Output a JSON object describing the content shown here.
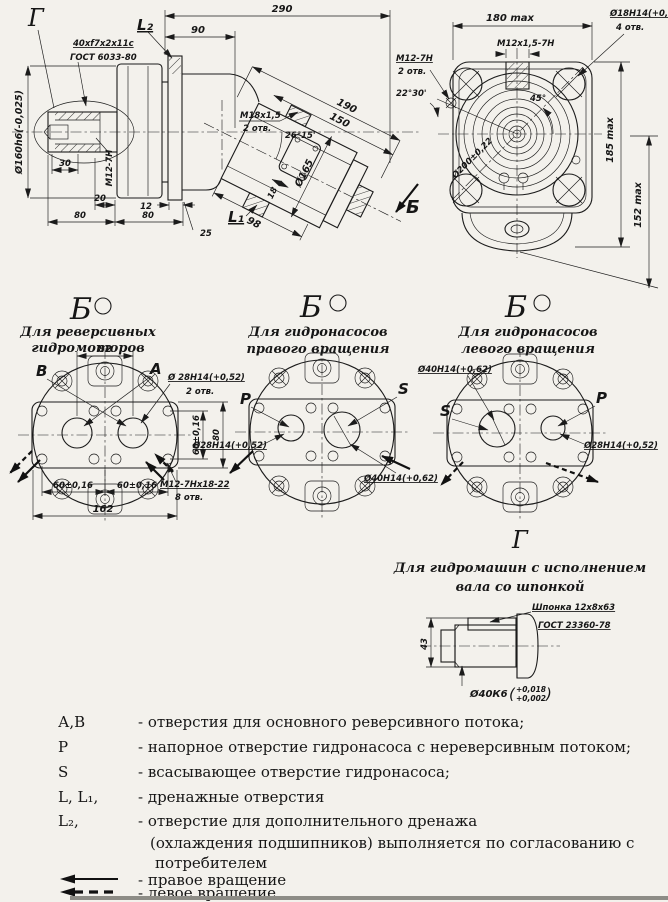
{
  "colors": {
    "paper": "#f3f1ec",
    "ink": "#1b1b1b"
  },
  "side_view": {
    "detail_ref": "Г",
    "spline_line1": "40xf7x2x11c",
    "spline_line2": "ГОСТ 6033-80",
    "dim_overall": "290",
    "dim_90": "90",
    "port_l2": "L₂",
    "dia_shaft": "Ø160h6(-0,025)",
    "thread_center": "M12-7H",
    "dim_30": "30",
    "dim_20": "20",
    "dim_80_left": "80",
    "dim_12": "12",
    "dim_80_right": "80",
    "dim_25": "25",
    "dim_190": "190",
    "dim_150": "150",
    "port_thread_line1": "M18x1,5",
    "port_thread_line2": "2 отв.",
    "angle_block": "26°15'",
    "dia_block": "Ø165",
    "dim_18": "18",
    "dim_98": "98",
    "view_ref": "Б",
    "port_l1": "L₁"
  },
  "front_view": {
    "dim_width": "180 max",
    "corner_holes_line1": "Ø18H14(+0,43)",
    "corner_holes_line2": "4 отв.",
    "thread_top": "M12x1,5-7H",
    "thread_side_line1": "M12-7H",
    "thread_side_line2": "2 отв.",
    "angle_small": "22°30'",
    "angle_diag": "45°",
    "dia_bolt_circle": "Ø200±0,22",
    "dim_height": "185 max",
    "dim_height2": "152 max"
  },
  "views_b": {
    "motor": {
      "ref": "Б",
      "subtitle1": "Для реверсивных",
      "subtitle2": "гидромоторов",
      "dim_82": "82",
      "label_left": "B",
      "label_right": "A",
      "callout_line1": "Ø 28H14(+0,52)",
      "callout_line2": "2 отв.",
      "dim_60_vert": "60±0,16",
      "dim_80": "80",
      "dim_60_a": "60±0,16",
      "dim_60_b": "60±0,16",
      "dim_162": "162",
      "bolt_callout_line1": "M12-7Hх18-22",
      "bolt_callout_line2": "8 отв."
    },
    "pump_right": {
      "ref": "Б",
      "subtitle1": "Для гидронасосов",
      "subtitle2": "правого вращения",
      "label_p": "P",
      "label_s": "S",
      "callout_28": "Ø28H14(+0,52)",
      "callout_40": "Ø40H14(+0,62)"
    },
    "pump_left": {
      "ref": "Б",
      "subtitle1": "Для гидронасосов",
      "subtitle2": "левого вращения",
      "label_s": "S",
      "label_p": "P",
      "callout_40": "Ø40H14(+0,62)",
      "callout_28": "Ø28H14(+0,52)"
    }
  },
  "view_g": {
    "ref": "Г",
    "subtitle1": "Для гидромашин с исполнением",
    "subtitle2": "вала со шпонкой",
    "key_line1": "Шпонка 12x8x63",
    "key_line2": "ГОСТ 23360-78",
    "dim_43": "43",
    "dia_shaft": "Ø40К6",
    "tol_open": "(",
    "tol_hi": "+0,018",
    "tol_lo": "+0,002",
    "tol_close": ")"
  },
  "legend": {
    "rows": [
      {
        "sym": "А,В",
        "text": "- отверстия для основного реверсивного потока;"
      },
      {
        "sym": "Р",
        "text": "- напорное отверстие гидронасоса с нереверсивным потоком;"
      },
      {
        "sym": "S",
        "text": "- всасывающее  отверстие гидронасоса;"
      },
      {
        "sym": "L, L₁,",
        "text": "- дренажные отверстия"
      },
      {
        "sym": "L₂,",
        "text": "- отверстие для дополнительного дренажа"
      },
      {
        "sym": "",
        "text": "(охлаждения подшипников) выполняется по согласованию с"
      },
      {
        "sym": "",
        "text": "потребителем"
      }
    ],
    "right_rotation": "- правое вращение",
    "left_rotation": "- левое вращение"
  }
}
